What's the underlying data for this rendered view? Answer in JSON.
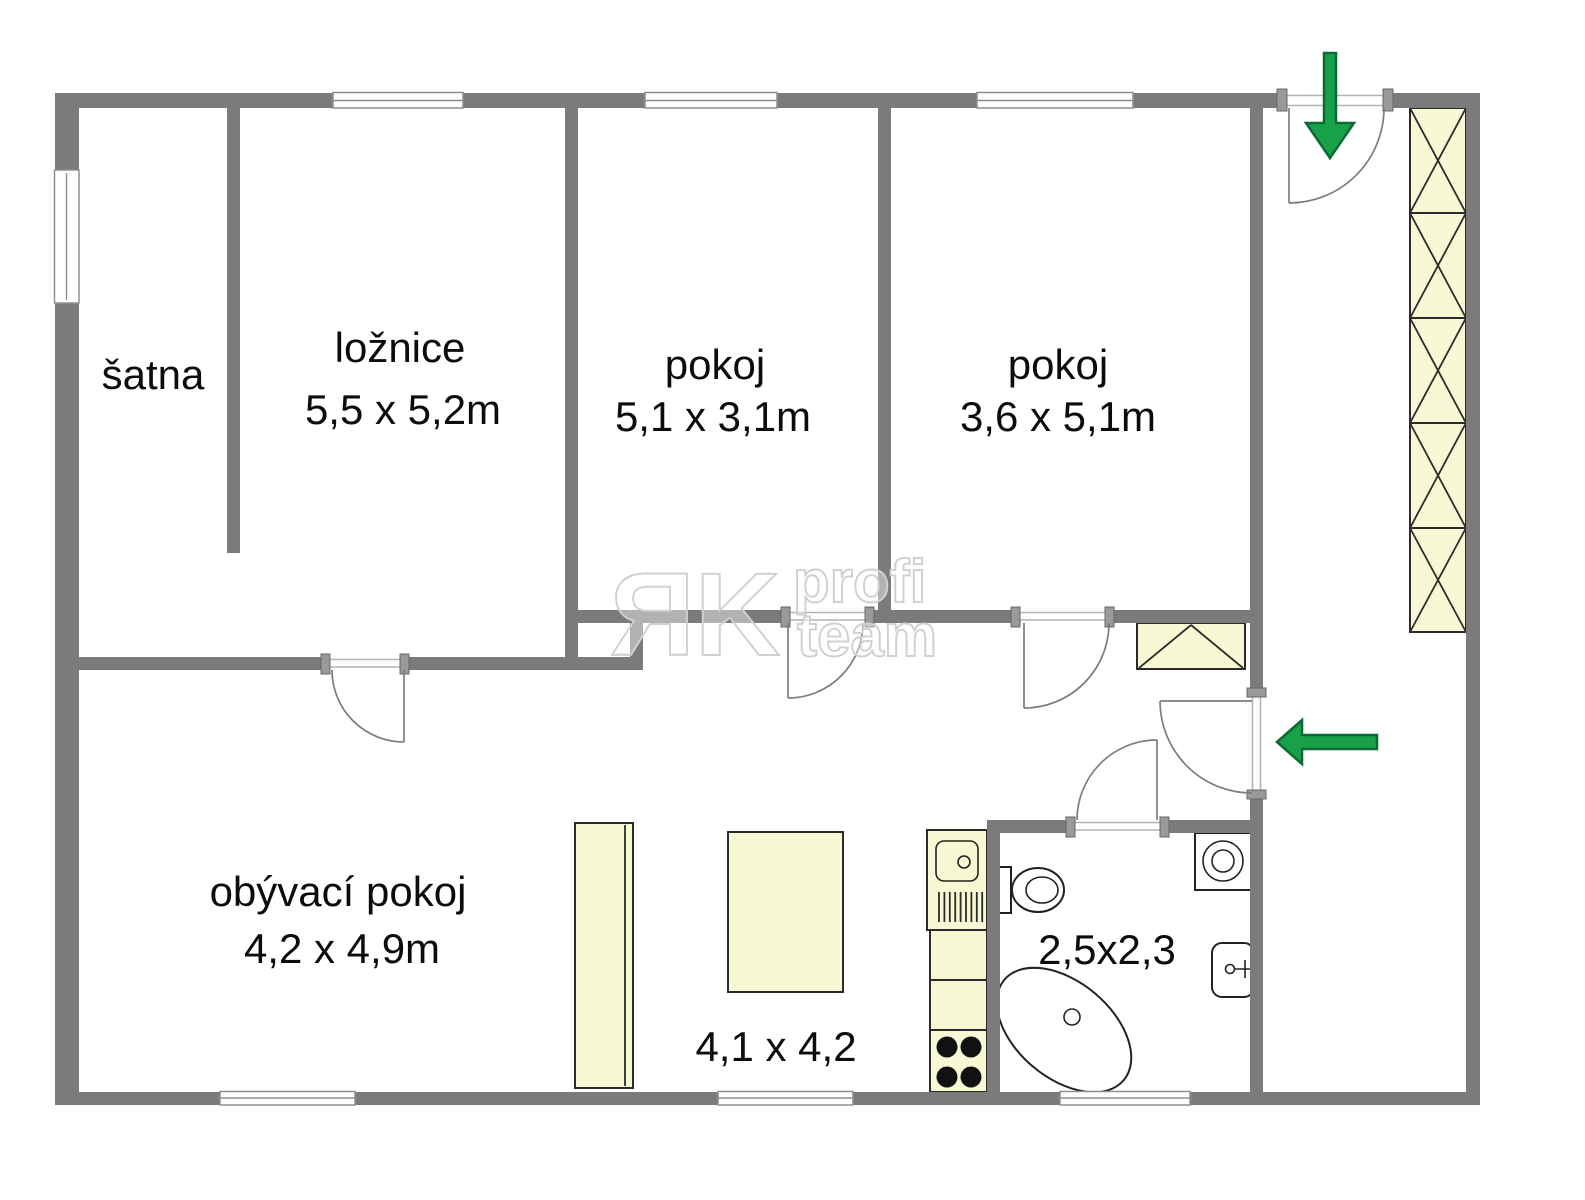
{
  "rooms": {
    "satna": {
      "label": "šatna"
    },
    "loznice": {
      "label": "ložnice",
      "dims": "5,5 x 5,2m"
    },
    "pokoj_a": {
      "label": "pokoj",
      "dims": "5,1 x 3,1m"
    },
    "pokoj_b": {
      "label": "pokoj",
      "dims": "3,6 x 5,1m"
    },
    "obyvaci": {
      "label": "obývací pokoj",
      "dims": "4,2 x 4,9m"
    },
    "kuchyn": {
      "dims": "4,1 x 4,2"
    },
    "koupelna": {
      "dims": "2,5x2,3"
    }
  },
  "watermark": {
    "logo": "ЯK",
    "word1": "profi",
    "word2": "team"
  },
  "entry_arrows": {
    "top_arrow_direction": "down",
    "side_arrow_direction": "left"
  },
  "colors": {
    "wall": "#7b7b7b",
    "threshold_line": "#b3b3b3",
    "window_line": "#8f8f8f",
    "furniture_fill": "#f8f8d5",
    "furniture_border": "#2b2b2b",
    "arrow_green": "#17a24a",
    "arrow_green_dark": "#0a6b33",
    "watermark_gray": "#d0d0d0",
    "text": "#0c0c0c"
  }
}
